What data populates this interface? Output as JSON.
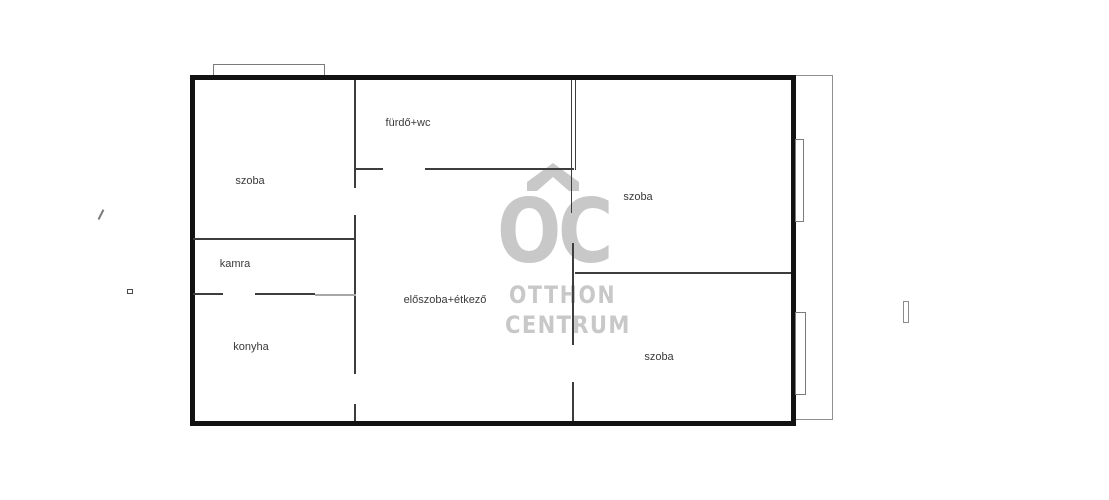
{
  "image": {
    "type": "floor-plan",
    "background": "#ffffff"
  },
  "floorplan": {
    "rooms": [
      {
        "name": "szoba-top-left",
        "label": "szoba"
      },
      {
        "name": "furdo-wc",
        "label": "fürdő+wc"
      },
      {
        "name": "kamra",
        "label": "kamra"
      },
      {
        "name": "konyha",
        "label": "konyha"
      },
      {
        "name": "eloszoba-etkezo",
        "label": "előszoba+étkező"
      },
      {
        "name": "szoba-top-right",
        "label": "szoba"
      },
      {
        "name": "szoba-bottom-right",
        "label": "szoba"
      }
    ],
    "colors": {
      "outer_wall": "#121212",
      "inner_wall": "#3d3d3d",
      "light_wall": "#a8a8a8",
      "thin_outline": "#7b7b7b",
      "label_text": "#3a3a3a"
    }
  },
  "watermark": {
    "letters": "OC",
    "line1": "OTTHON",
    "line2": "CENTRUM",
    "color": "#c8c8c8",
    "icon": "house-roof-icon"
  }
}
